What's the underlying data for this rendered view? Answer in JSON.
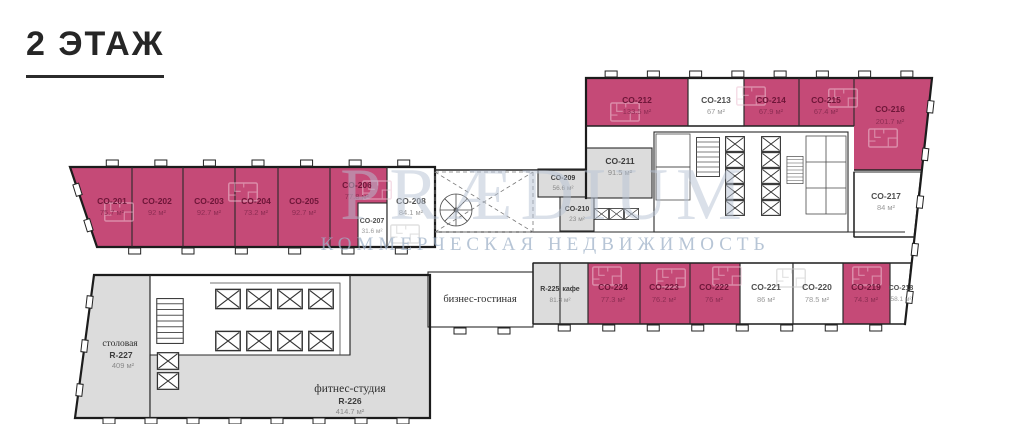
{
  "title": "2 ЭТАЖ",
  "watermark": {
    "brand": "PRÆDIUM",
    "tagline": "КОММЕРЧЕСКАЯ НЕДВИЖИМОСТЬ"
  },
  "colors": {
    "available": "#c54a77",
    "common": "#dcdcdc",
    "vacant": "#ffffff",
    "wall": "#1c1c1c"
  },
  "rooms": {
    "co201": {
      "name": "CO-201",
      "area": "75.7 м²",
      "status": "available"
    },
    "co202": {
      "name": "CO-202",
      "area": "92 м²",
      "status": "available"
    },
    "co203": {
      "name": "CO-203",
      "area": "92.7 м²",
      "status": "available"
    },
    "co204": {
      "name": "CO-204",
      "area": "73.2 м²",
      "status": "available"
    },
    "co205": {
      "name": "CO-205",
      "area": "92.7 м²",
      "status": "available"
    },
    "co206": {
      "name": "CO-206",
      "area": "77.8 м²",
      "status": "available"
    },
    "co207": {
      "name": "CO-207",
      "area": "31.6 м²",
      "status": "vacant"
    },
    "co208": {
      "name": "CO-208",
      "area": "84.1 м²",
      "status": "vacant"
    },
    "co209": {
      "name": "CO-209",
      "area": "56.6 м²",
      "status": "common"
    },
    "co210": {
      "name": "CO-210",
      "area": "23 м²",
      "status": "common"
    },
    "co211": {
      "name": "CO-211",
      "area": "91.5 м²",
      "status": "common"
    },
    "co212": {
      "name": "CO-212",
      "area": "133.5 м²",
      "status": "available"
    },
    "co213": {
      "name": "CO-213",
      "area": "67 м²",
      "status": "vacant"
    },
    "co214": {
      "name": "CO-214",
      "area": "67.9 м²",
      "status": "available"
    },
    "co215": {
      "name": "CO-215",
      "area": "67.4 м²",
      "status": "available"
    },
    "co216": {
      "name": "CO-216",
      "area": "201.7 м²",
      "status": "available"
    },
    "co217": {
      "name": "CO-217",
      "area": "84 м²",
      "status": "vacant"
    },
    "co218": {
      "name": "CO-218",
      "area": "58.1 м²",
      "status": "vacant"
    },
    "co219": {
      "name": "CO-219",
      "area": "74.3 м²",
      "status": "available"
    },
    "co220": {
      "name": "CO-220",
      "area": "78.5 м²",
      "status": "vacant"
    },
    "co221": {
      "name": "CO-221",
      "area": "86 м²",
      "status": "vacant"
    },
    "co222": {
      "name": "CO-222",
      "area": "76 м²",
      "status": "available"
    },
    "co223": {
      "name": "CO-223",
      "area": "76.2 м²",
      "status": "available"
    },
    "co224": {
      "name": "CO-224",
      "area": "77.3 м²",
      "status": "available"
    }
  },
  "amenities": {
    "lounge": {
      "label": "бизнес-гостиная"
    },
    "cafe": {
      "name": "R-225",
      "label": "кафе",
      "area": "81.8 м²"
    },
    "fitness": {
      "label": "фитнес-студия",
      "name": "R-226",
      "area": "414.7 м²"
    },
    "canteen": {
      "label": "столовая",
      "name": "R-227",
      "area": "409 м²"
    }
  }
}
